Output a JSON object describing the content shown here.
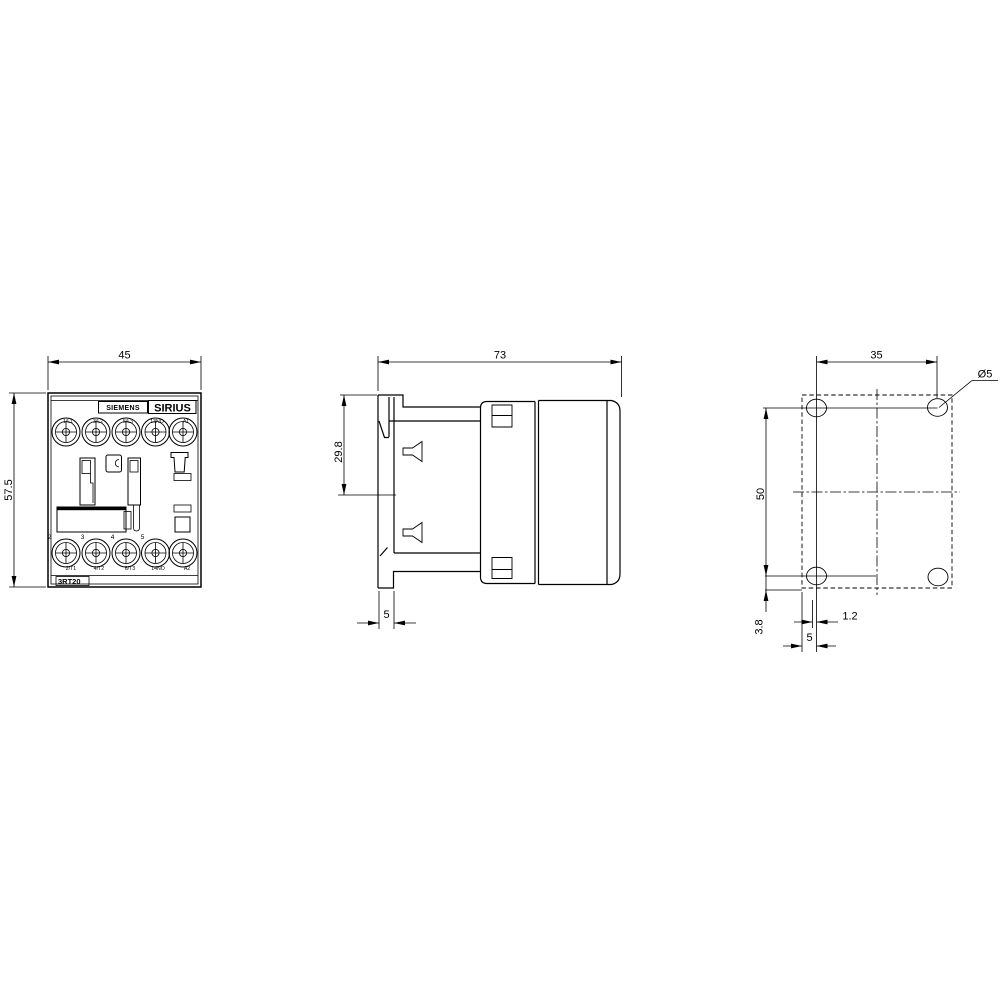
{
  "front_view": {
    "brand_label": "SIEMENS",
    "series_label": "SIRIUS",
    "model_label": "3RT20",
    "width_dim": "45",
    "height_dim": "57.5",
    "terminals_top": [
      "1/L1",
      "3/L2",
      "5/L3",
      "13NO",
      "A1"
    ],
    "terminals_bottom": [
      "2/T1",
      "4/T2",
      "6/T3",
      "14NO",
      "A2"
    ],
    "pole_numbers": [
      "2",
      "3",
      "4",
      "5"
    ]
  },
  "side_view": {
    "depth_dim": "73",
    "clip_offset_dim": "29.8",
    "foot_width_dim": "5"
  },
  "drill_plan": {
    "hole_spacing_horizontal": "35",
    "hole_spacing_vertical": "50",
    "hole_diameter": "Ø5",
    "hole_to_edge": "3.8",
    "center_offset": "1.2",
    "edge_to_hole_center": "5"
  },
  "colors": {
    "line": "#000000",
    "background": "#ffffff"
  }
}
